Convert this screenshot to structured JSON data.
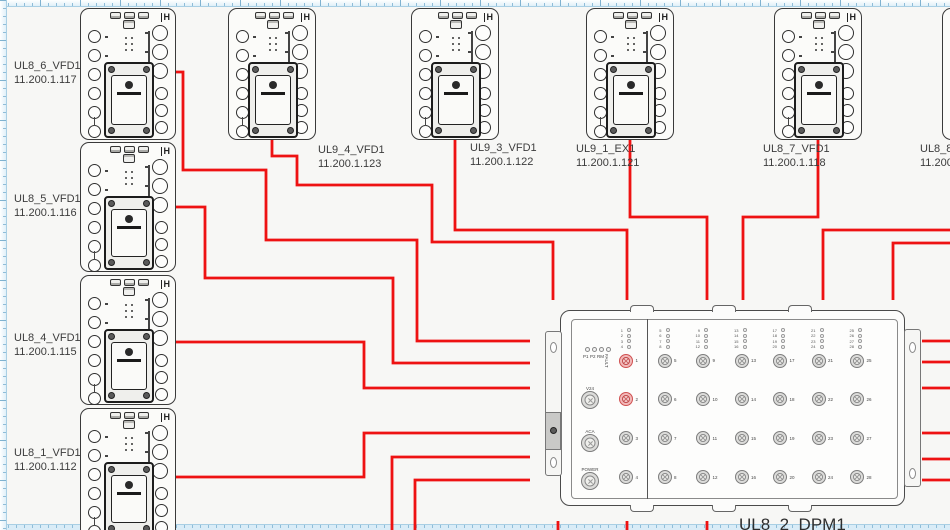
{
  "app": {
    "background": "#f7f7f5",
    "wire_color": "#ee1212",
    "ruler_tint": "#e0f0f9",
    "highlight_port_color": "#d05050"
  },
  "devices": [
    {
      "name": "UL8_6_VFD1",
      "ip": "11.200.1.117",
      "x": 80,
      "y": 8,
      "w": 96,
      "h": 132,
      "label": {
        "x": 14,
        "y": 59
      }
    },
    {
      "name": "UL8_5_VFD1",
      "ip": "11.200.1.116",
      "x": 80,
      "y": 142,
      "w": 96,
      "h": 130,
      "label": {
        "x": 14,
        "y": 192
      }
    },
    {
      "name": "UL8_4_VFD1",
      "ip": "11.200.1.115",
      "x": 80,
      "y": 275,
      "w": 96,
      "h": 130,
      "label": {
        "x": 14,
        "y": 331
      }
    },
    {
      "name": "UL8_1_VFD1",
      "ip": "11.200.1.112",
      "x": 80,
      "y": 408,
      "w": 96,
      "h": 130,
      "label": {
        "x": 14,
        "y": 446
      }
    },
    {
      "name": "UL9_4_VFD1",
      "ip": "11.200.1.123",
      "x": 228,
      "y": 8,
      "w": 88,
      "h": 132,
      "label": {
        "x": 318,
        "y": 143
      }
    },
    {
      "name": "UL9_3_VFD1",
      "ip": "11.200.1.122",
      "x": 411,
      "y": 8,
      "w": 88,
      "h": 132,
      "label": {
        "x": 470,
        "y": 141
      }
    },
    {
      "name": "UL9_1_EX1",
      "ip": "11.200.1.121",
      "x": 586,
      "y": 8,
      "w": 88,
      "h": 132,
      "label": {
        "x": 576,
        "y": 142
      }
    },
    {
      "name": "UL8_7_VFD1",
      "ip": "11.200.1.118",
      "x": 774,
      "y": 8,
      "w": 88,
      "h": 132,
      "label": {
        "x": 763,
        "y": 142
      }
    },
    {
      "name": "UL8_8_V",
      "ip": "11.200.",
      "x": 942,
      "y": 8,
      "w": 88,
      "h": 132,
      "label": {
        "x": 920,
        "y": 142
      }
    }
  ],
  "dpm": {
    "name": "UL8_2_DPM1",
    "x": 560,
    "y": 310,
    "w": 345,
    "h": 196,
    "label": {
      "x": 739,
      "y": 515
    },
    "status_leds": [
      "P1",
      "P2",
      "RM",
      "FAULT"
    ],
    "aux_connectors": [
      "V24",
      "ACA",
      "POWER"
    ],
    "port_cols": 7,
    "port_rows": 4,
    "port_numbers": [
      1,
      2,
      3,
      4,
      5,
      6,
      7,
      8,
      9,
      10,
      11,
      12,
      13,
      14,
      15,
      16,
      17,
      18,
      19,
      20,
      21,
      22,
      23,
      24,
      25,
      26,
      27,
      28
    ],
    "highlighted_ports": [
      1,
      2
    ]
  },
  "wires": [
    {
      "from": "UL8_6_VFD1",
      "to": "UL8_2_DPM1",
      "points": [
        [
          176,
          72
        ],
        [
          183,
          72
        ],
        [
          183,
          170
        ],
        [
          266,
          170
        ],
        [
          266,
          240
        ],
        [
          417,
          240
        ],
        [
          417,
          341
        ],
        [
          530,
          341
        ]
      ]
    },
    {
      "from": "UL8_5_VFD1",
      "to": "UL8_2_DPM1",
      "points": [
        [
          176,
          207
        ],
        [
          205,
          207
        ],
        [
          205,
          278
        ],
        [
          393,
          278
        ],
        [
          393,
          363
        ],
        [
          530,
          363
        ]
      ]
    },
    {
      "from": "UL8_4_VFD1",
      "to": "UL8_2_DPM1",
      "points": [
        [
          176,
          342
        ],
        [
          364,
          342
        ],
        [
          364,
          388
        ],
        [
          530,
          388
        ]
      ]
    },
    {
      "from": "UL8_1_VFD1",
      "to": "UL8_2_DPM1",
      "points": [
        [
          176,
          477
        ],
        [
          364,
          477
        ],
        [
          364,
          433
        ],
        [
          530,
          433
        ]
      ]
    },
    {
      "from": "offscreen-bottom",
      "to": "UL8_2_DPM1",
      "points": [
        [
          392,
          531
        ],
        [
          392,
          457
        ],
        [
          530,
          457
        ]
      ]
    },
    {
      "from": "offscreen-bottom",
      "to": "UL8_2_DPM1",
      "points": [
        [
          415,
          531
        ],
        [
          415,
          480
        ],
        [
          530,
          480
        ]
      ]
    },
    {
      "from": "UL9_4_VFD1",
      "to": "UL8_2_DPM1",
      "points": [
        [
          272,
          140
        ],
        [
          272,
          156
        ],
        [
          297,
          156
        ],
        [
          297,
          185
        ],
        [
          432,
          185
        ],
        [
          432,
          242
        ],
        [
          553,
          242
        ],
        [
          553,
          300
        ]
      ]
    },
    {
      "from": "UL9_3_VFD1",
      "to": "UL8_2_DPM1",
      "points": [
        [
          455,
          140
        ],
        [
          455,
          230
        ],
        [
          627,
          230
        ],
        [
          627,
          300
        ]
      ]
    },
    {
      "from": "UL9_1_EX1",
      "to": "UL8_2_DPM1",
      "points": [
        [
          630,
          140
        ],
        [
          630,
          217
        ],
        [
          707,
          217
        ],
        [
          707,
          300
        ]
      ]
    },
    {
      "from": "UL8_7_VFD1",
      "to": "UL8_2_DPM1",
      "points": [
        [
          818,
          140
        ],
        [
          818,
          217
        ],
        [
          743,
          217
        ],
        [
          743,
          300
        ]
      ]
    },
    {
      "from": "offscreen-right",
      "to": "UL8_2_DPM1",
      "points": [
        [
          951,
          230
        ],
        [
          823,
          230
        ],
        [
          823,
          300
        ]
      ]
    },
    {
      "from": "offscreen-right",
      "to": "UL8_2_DPM1",
      "points": [
        [
          951,
          243
        ],
        [
          893,
          243
        ],
        [
          893,
          300
        ]
      ]
    },
    {
      "from": "UL8_2_DPM1",
      "to": "offscreen-right",
      "points": [
        [
          922,
          341
        ],
        [
          951,
          341
        ]
      ]
    },
    {
      "from": "UL8_2_DPM1",
      "to": "offscreen-right",
      "points": [
        [
          922,
          362
        ],
        [
          951,
          362
        ]
      ]
    },
    {
      "from": "UL8_2_DPM1",
      "to": "offscreen-right",
      "points": [
        [
          922,
          388
        ],
        [
          951,
          388
        ]
      ]
    },
    {
      "from": "UL8_2_DPM1",
      "to": "offscreen-right",
      "points": [
        [
          922,
          433
        ],
        [
          951,
          433
        ]
      ]
    },
    {
      "from": "UL8_2_DPM1",
      "to": "offscreen-right",
      "points": [
        [
          922,
          459
        ],
        [
          951,
          459
        ]
      ]
    },
    {
      "from": "UL8_2_DPM1",
      "to": "offscreen-right",
      "points": [
        [
          922,
          480
        ],
        [
          951,
          480
        ]
      ]
    },
    {
      "from": "UL8_2_DPM1",
      "to": "offscreen-bottom",
      "points": [
        [
          558,
          521
        ],
        [
          558,
          531
        ]
      ]
    },
    {
      "from": "UL8_2_DPM1",
      "to": "offscreen-bottom",
      "points": [
        [
          627,
          521
        ],
        [
          627,
          531
        ]
      ]
    },
    {
      "from": "UL8_2_DPM1",
      "to": "offscreen-bottom",
      "points": [
        [
          707,
          521
        ],
        [
          707,
          531
        ]
      ]
    }
  ]
}
